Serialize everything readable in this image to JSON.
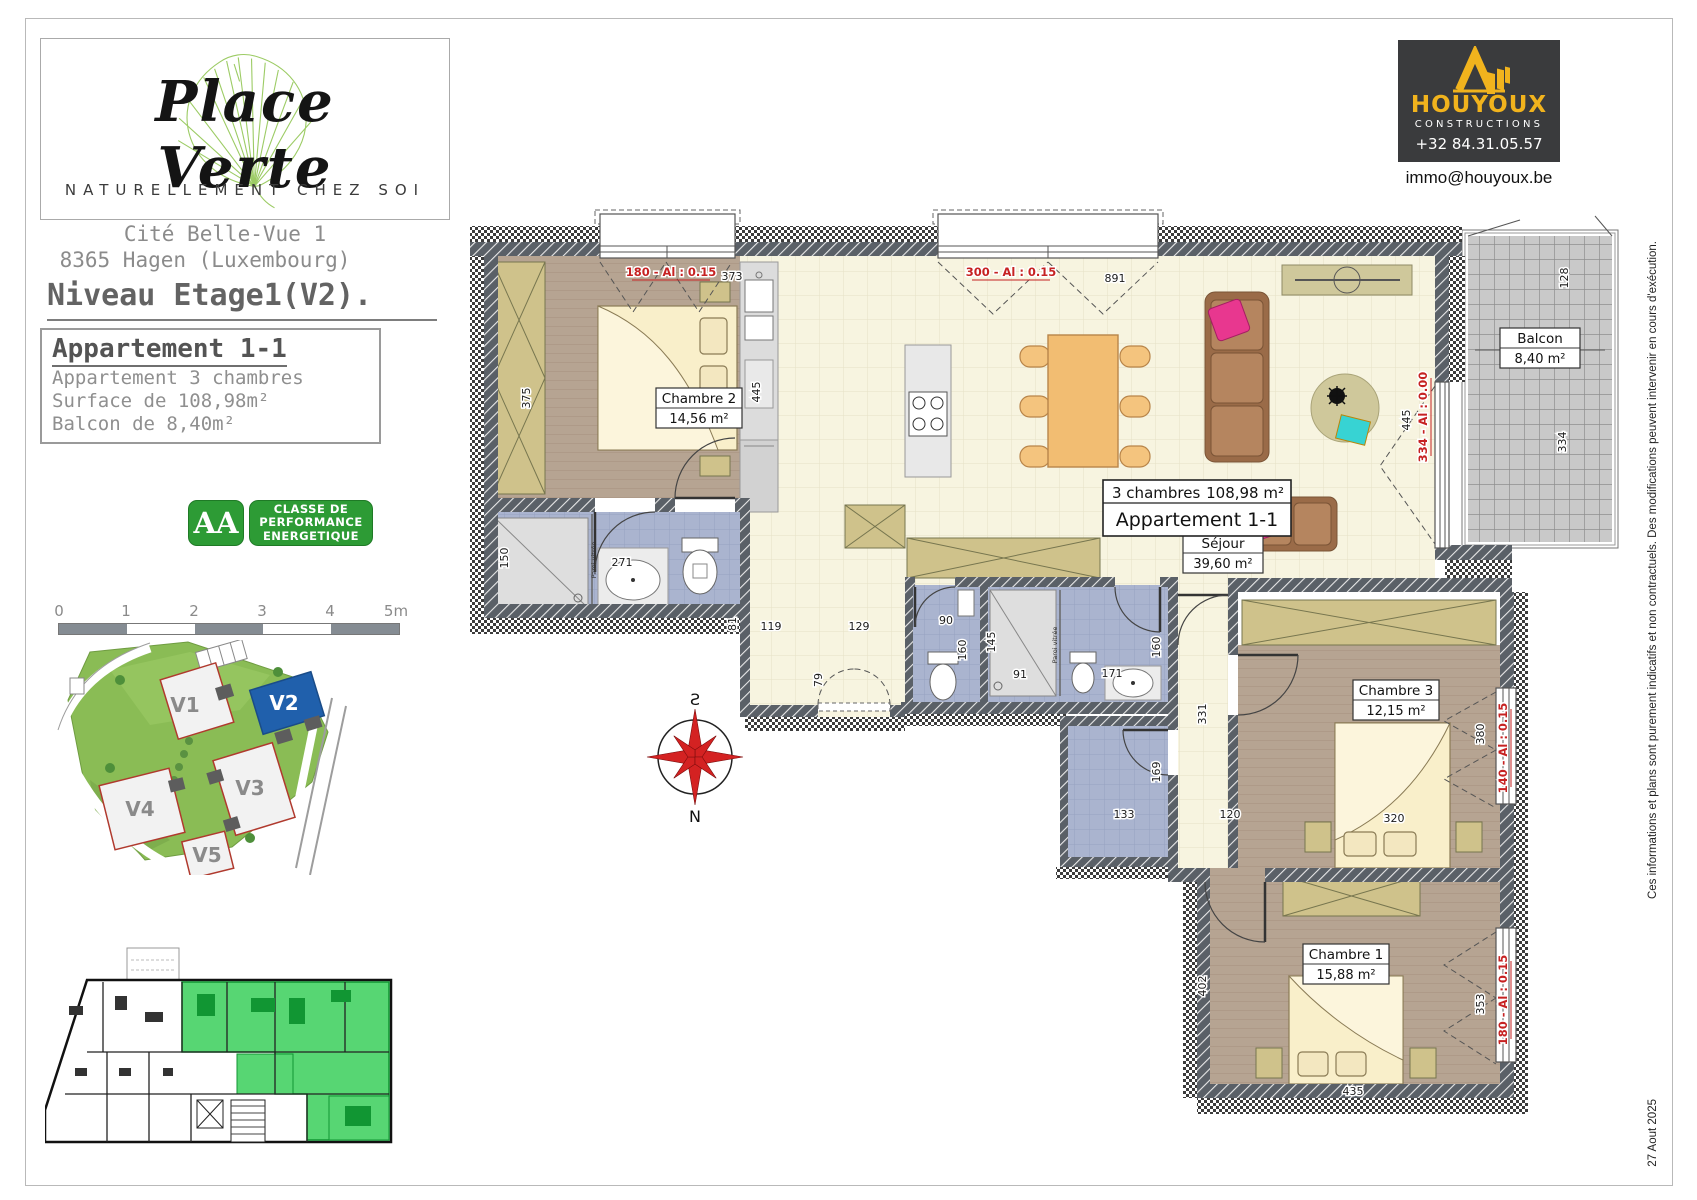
{
  "colors": {
    "energy_green": "#2d9b35",
    "v2_blue": "#2060ac",
    "unit_highlight_green": "#57d673",
    "builder_yellow": "#f1b31d",
    "wall_gray": "#5a6067",
    "window_label_red": "#c62222"
  },
  "branding": {
    "name": "Place Verte",
    "tagline": "NATURELLEMENT CHEZ SOI"
  },
  "project": {
    "address_line1": "Cité Belle-Vue 1",
    "address_line2": "8365 Hagen (Luxembourg)",
    "level_title": "Niveau Etage1(V2)."
  },
  "apartment_box": {
    "title": "Appartement 1-1",
    "line1": "Appartement 3 chambres",
    "line2": "Surface de 108,98m²",
    "line3": "Balcon de 8,40m²"
  },
  "energy": {
    "grade": "AA",
    "label_line1": "CLASSE DE",
    "label_line2": "PERFORMANCE",
    "label_line3": "ENERGETIQUE"
  },
  "scalebar": {
    "t0": "0",
    "t1": "1",
    "t2": "2",
    "t3": "3",
    "t4": "4",
    "t5": "5m"
  },
  "siteplan": {
    "v1": "V1",
    "v2": "V2",
    "v3": "V3",
    "v4": "V4",
    "v5": "V5"
  },
  "builder": {
    "name": "HOUYOUX",
    "subtitle": "CONSTRUCTIONS",
    "phone": "+32 84.31.05.57",
    "email": "immo@houyoux.be"
  },
  "margin": {
    "disclaimer": "Ces informations et plans sont purement indicatifs et non contractuels.  Des modifications peuvent intervenir en cours d'exécution.",
    "date": "27 Aout 2025"
  },
  "plan": {
    "summary": {
      "line1_left": "3 chambres",
      "line1_right": "108,98 m²",
      "line2": "Appartement 1-1"
    },
    "rooms": {
      "chambre2": {
        "name": "Chambre 2",
        "area": "14,56 m²"
      },
      "sejour": {
        "name": "Séjour",
        "area": "39,60 m²"
      },
      "chambre3": {
        "name": "Chambre 3",
        "area": "12,15 m²"
      },
      "chambre1": {
        "name": "Chambre 1",
        "area": "15,88 m²"
      },
      "balcon": {
        "name": "Balcon",
        "area": "8,40 m²"
      }
    },
    "windows": {
      "chambre2": "180 - Al : 0.15",
      "sejour": "300 - Al : 0.15",
      "balcon": "334 - Al : 0.00",
      "chambre3": "140 - Al : 0.15",
      "chambre1": "180 - Al : 0.15"
    },
    "dims": {
      "d373": "373",
      "d375": "375",
      "d445a": "445",
      "d891": "891",
      "d445b": "445",
      "d128": "128",
      "d334": "334",
      "d150": "150",
      "d271": "271",
      "d81": "81",
      "d119": "119",
      "d129": "129",
      "d79": "79",
      "d90": "90",
      "d160a": "160",
      "d145": "145",
      "d91": "91",
      "d171": "171",
      "d160b": "160",
      "d331": "331",
      "d169": "169",
      "d133": "133",
      "d120": "120",
      "d380": "380",
      "d320": "320",
      "d402": "402",
      "d353": "353",
      "d435": "435"
    },
    "notes": {
      "paroi1": "Paroi vitrée",
      "paroi2": "Paroi vitrée"
    },
    "compass": {
      "south": "S",
      "north": "N"
    }
  }
}
